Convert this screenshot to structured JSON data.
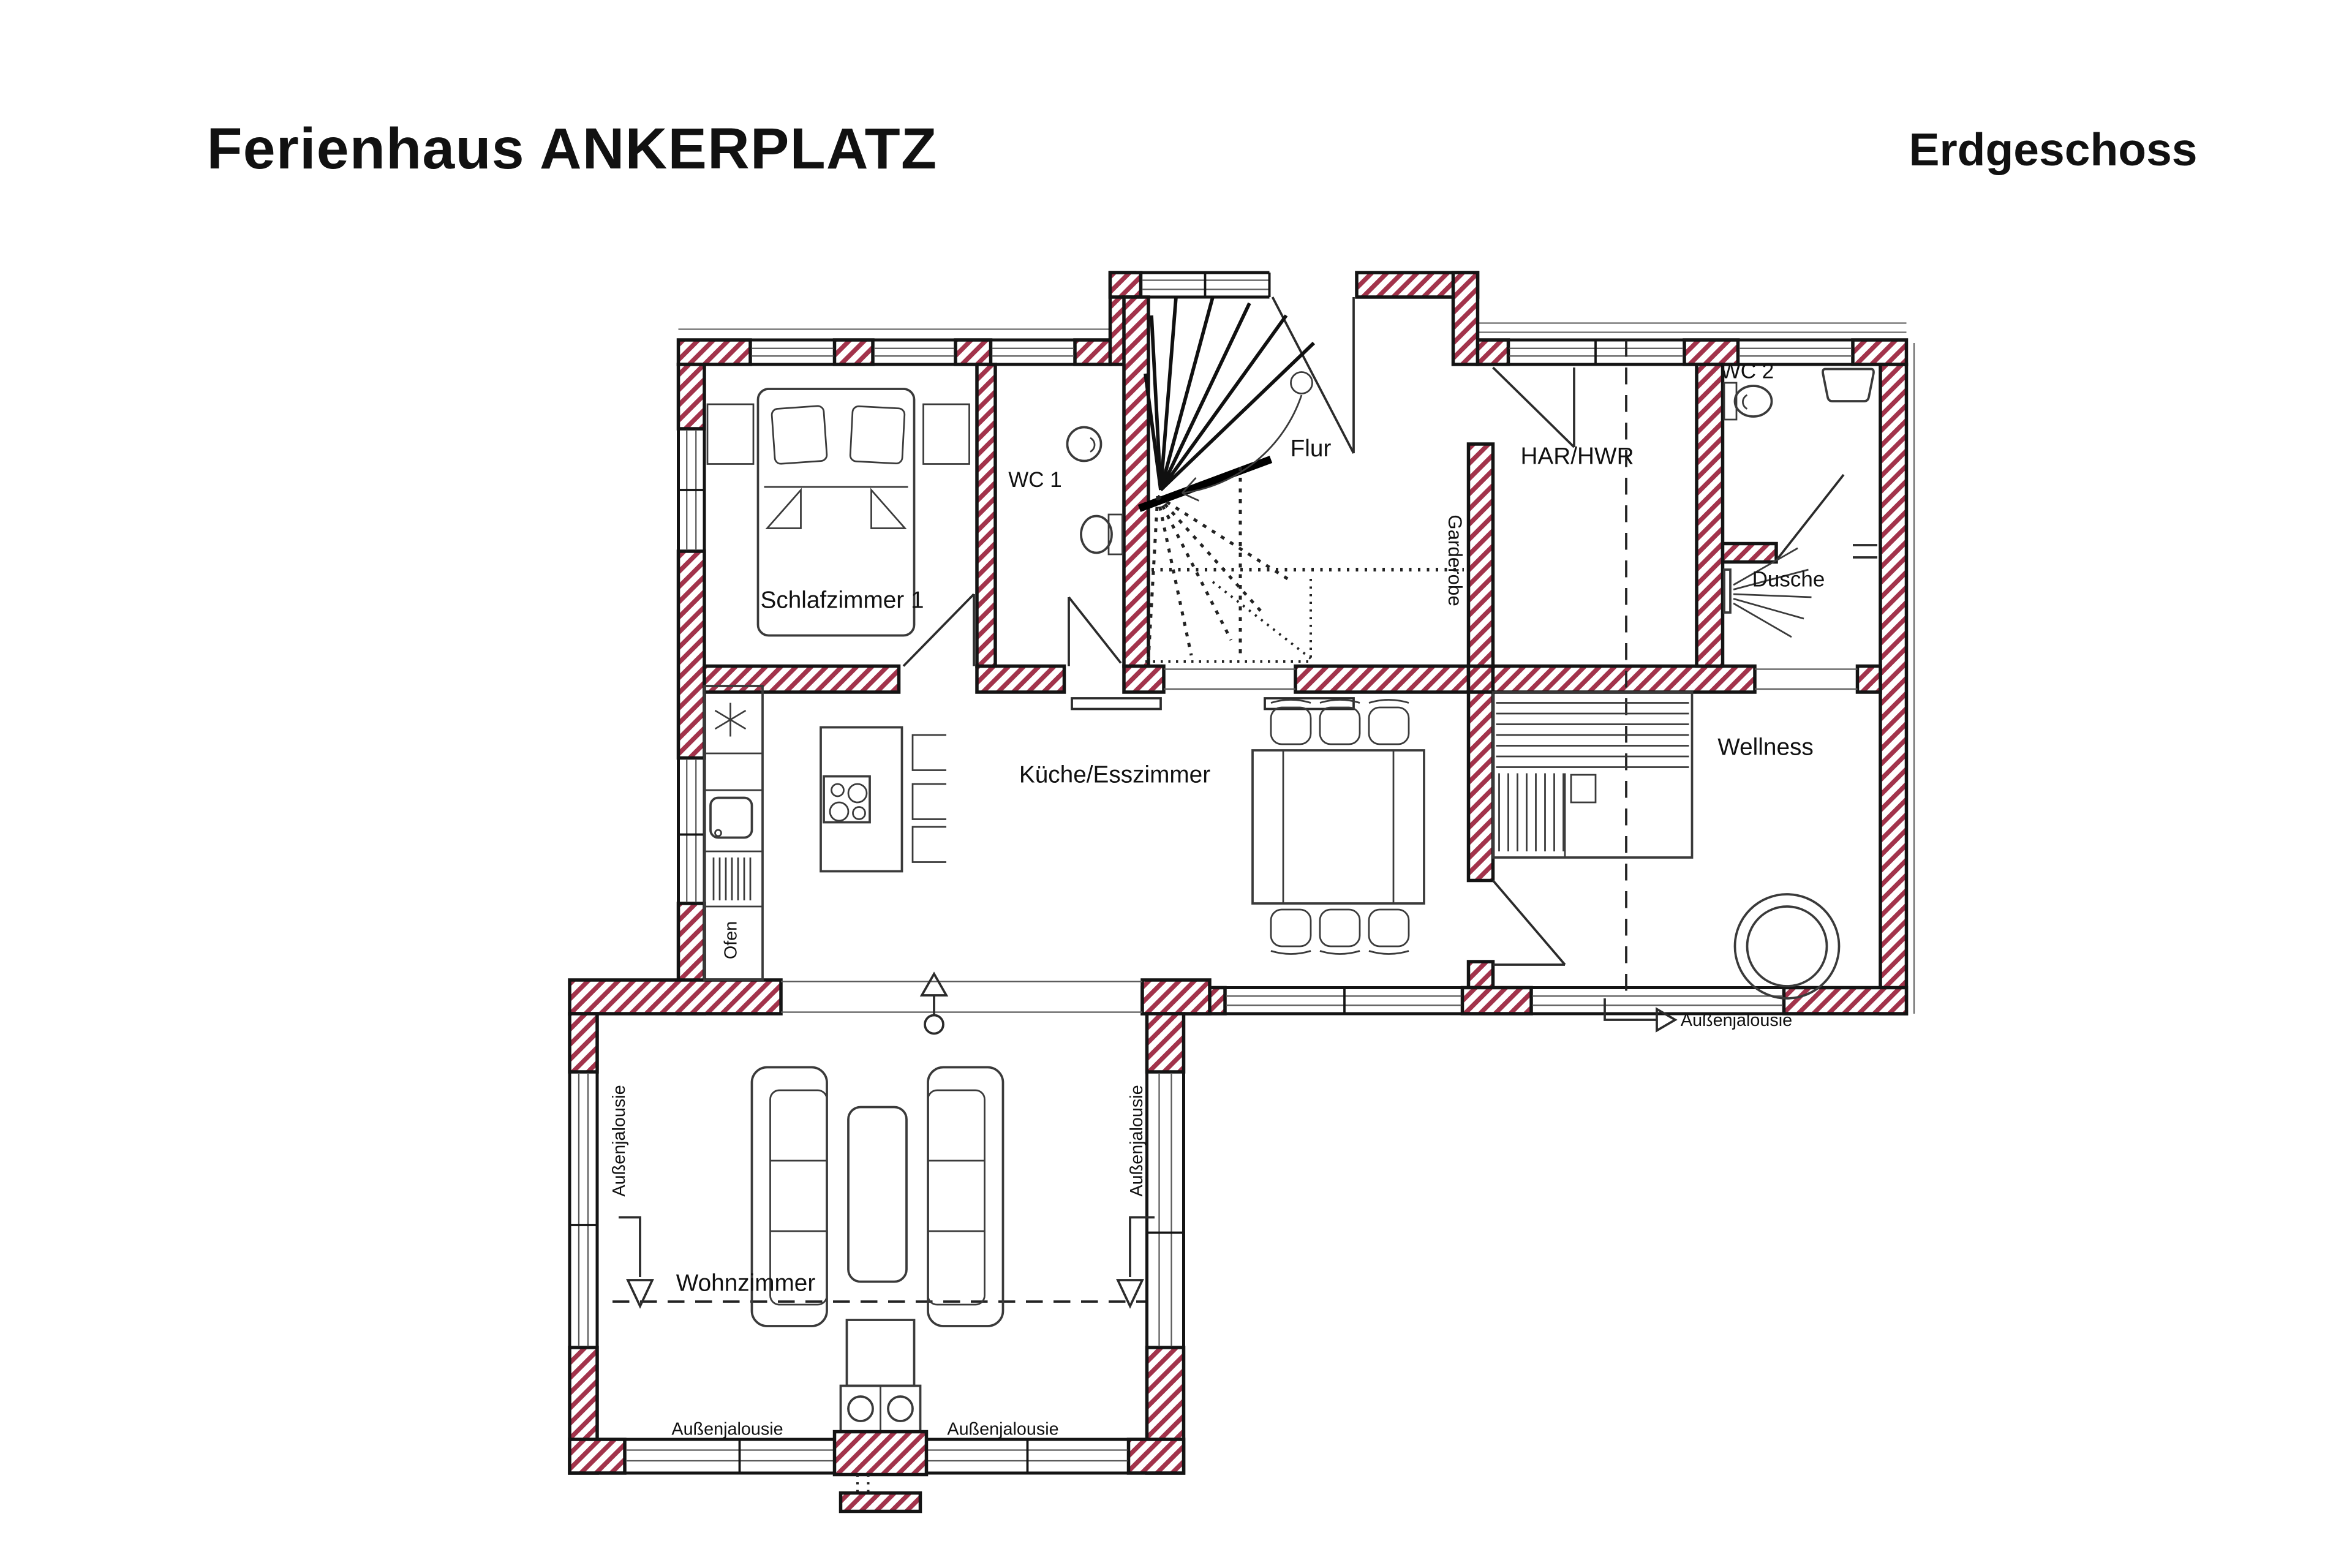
{
  "page": {
    "title": "Ferienhaus ANKERPLATZ",
    "floor_label": "Erdgeschoss"
  },
  "rooms": {
    "schlafzimmer1": "Schlafzimmer 1",
    "wc1": "WC 1",
    "flur": "Flur",
    "har_hwr": "HAR/HWR",
    "wc2": "WC 2",
    "dusche": "Dusche",
    "garderobe": "Garderobe",
    "kueche_esszimmer": "Küche/Esszimmer",
    "wellness": "Wellness",
    "wohnzimmer": "Wohnzimmer",
    "ofen": "Ofen"
  },
  "annotations": {
    "aussenjalousie": "Außenjalousie"
  },
  "colors": {
    "wall_hatch": "#a2334b",
    "wall_outline": "#141414",
    "drawing_line": "#3a3a3a"
  }
}
